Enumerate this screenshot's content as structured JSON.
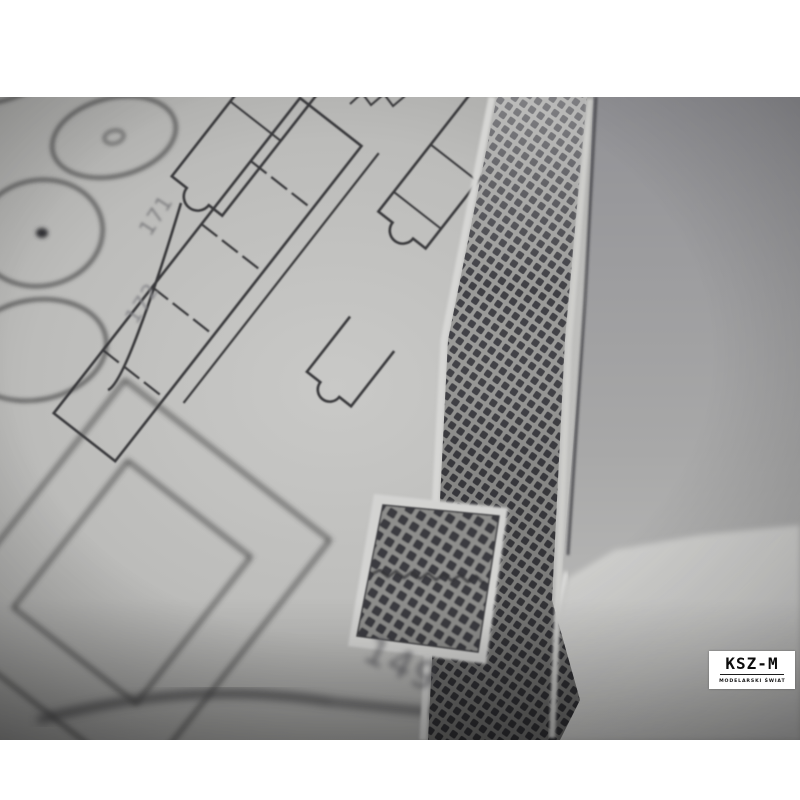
{
  "photo": {
    "part_labels": {
      "l171": "171",
      "l172": "172",
      "l149": "149"
    },
    "watermark": {
      "name": "KSZ-M",
      "tagline": "MODELARSKI ŚWIAT"
    },
    "palette": {
      "background": "#ffffff",
      "paper": "#c6c6c4",
      "ink": "#3a3a3c",
      "mesh_light": "#9a9a98",
      "mesh_dark": "#3f3f44",
      "watermark_bg": "#ffffff",
      "watermark_fg": "#0c0c0c"
    }
  }
}
